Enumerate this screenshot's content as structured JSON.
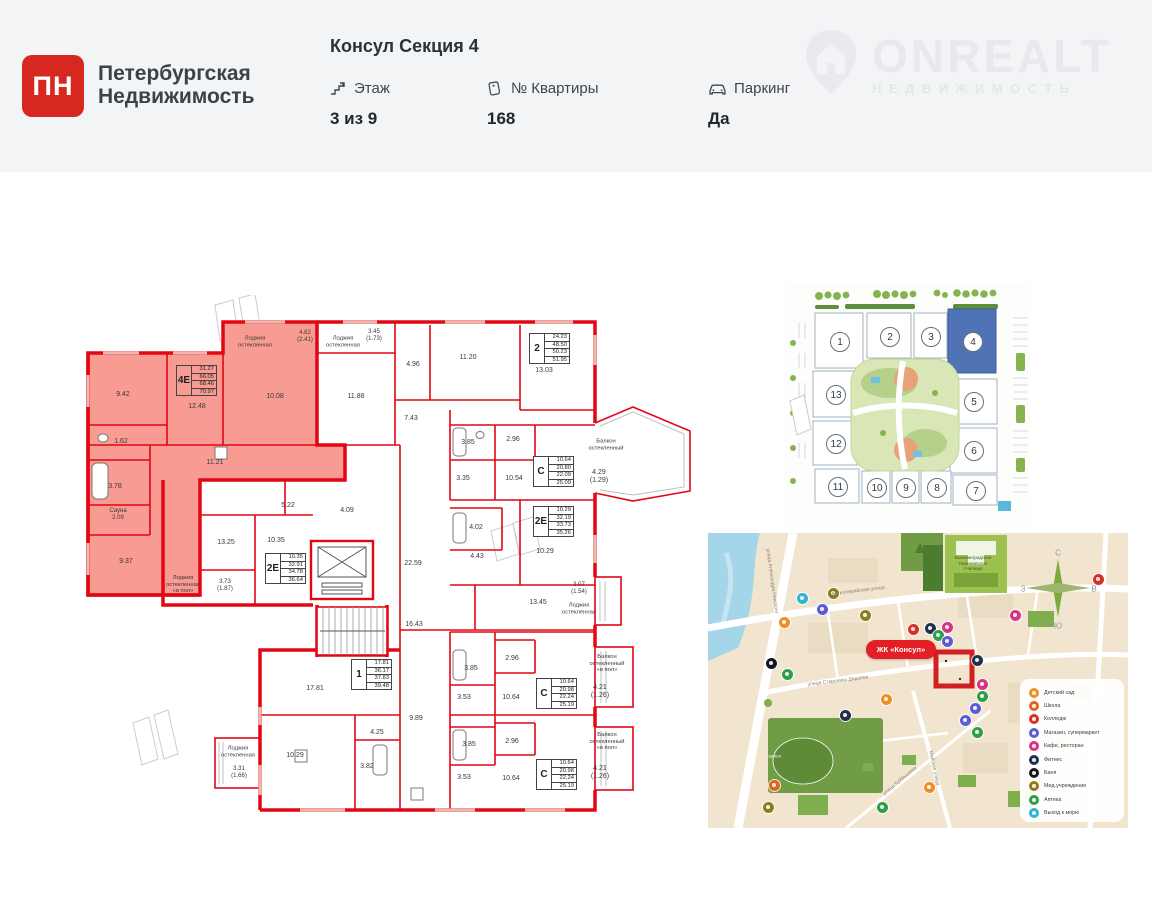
{
  "header": {
    "brand": {
      "logo_text": "ПН",
      "name_line1": "Петербургская",
      "name_line2": "Недвижимость"
    },
    "title": "Консул Секция 4",
    "stats": [
      {
        "icon": "stairs-icon",
        "label": "Этаж",
        "value": "3 из 9"
      },
      {
        "icon": "tag-icon",
        "label": "№ Квартиры",
        "value": "168"
      },
      {
        "icon": "car-icon",
        "label": "Паркинг",
        "value": "Да"
      }
    ],
    "watermark": {
      "text": "ONREALT",
      "subtext": "НЕДВИЖИМОСТЬ"
    }
  },
  "floorplan": {
    "wall_color": "#e30613",
    "highlight_color": "#f89b92",
    "labels": [
      {
        "t": "9.42",
        "x": 68,
        "y": 100
      },
      {
        "t": "12.48",
        "x": 142,
        "y": 112
      },
      {
        "t": "10.08",
        "x": 220,
        "y": 102
      },
      {
        "t": "11.21",
        "x": 160,
        "y": 168
      },
      {
        "t": "1.62",
        "x": 66,
        "y": 147
      },
      {
        "t": "3.78",
        "x": 60,
        "y": 192
      },
      {
        "t": "Сауна\n2.09",
        "x": 63,
        "y": 220,
        "s": 6
      },
      {
        "t": "9.37",
        "x": 71,
        "y": 267
      },
      {
        "t": "Лоджия\nостекленная",
        "x": 200,
        "y": 47,
        "s": 5.8
      },
      {
        "t": "4.82\n(2.41)",
        "x": 250,
        "y": 42,
        "s": 6
      },
      {
        "t": "Лоджия\nостекленная",
        "x": 288,
        "y": 47,
        "s": 5.8
      },
      {
        "t": "3.45\n(1.73)",
        "x": 319,
        "y": 41,
        "s": 6
      },
      {
        "t": "11.88",
        "x": 301,
        "y": 102
      },
      {
        "t": "4.96",
        "x": 358,
        "y": 70
      },
      {
        "t": "11.20",
        "x": 413,
        "y": 63
      },
      {
        "t": "13.03",
        "x": 489,
        "y": 76
      },
      {
        "t": "7.43",
        "x": 356,
        "y": 124
      },
      {
        "t": "3.85",
        "x": 413,
        "y": 148
      },
      {
        "t": "2.96",
        "x": 458,
        "y": 145
      },
      {
        "t": "3.35",
        "x": 408,
        "y": 184
      },
      {
        "t": "10.54",
        "x": 459,
        "y": 184
      },
      {
        "t": "Балкон\nостекленный",
        "x": 551,
        "y": 150,
        "s": 5.8
      },
      {
        "t": "4.29\n(1.29)",
        "x": 544,
        "y": 182
      },
      {
        "t": "5.22",
        "x": 233,
        "y": 211
      },
      {
        "t": "4.09",
        "x": 292,
        "y": 216
      },
      {
        "t": "4.02",
        "x": 421,
        "y": 233
      },
      {
        "t": "4.43",
        "x": 422,
        "y": 262
      },
      {
        "t": "22.59",
        "x": 358,
        "y": 269
      },
      {
        "t": "10.29",
        "x": 490,
        "y": 257
      },
      {
        "t": "13.45",
        "x": 483,
        "y": 308
      },
      {
        "t": "3.07\n(1.54)",
        "x": 524,
        "y": 294,
        "s": 6
      },
      {
        "t": "Лоджия\nостекленная",
        "x": 524,
        "y": 314,
        "s": 5.8
      },
      {
        "t": "13.25",
        "x": 171,
        "y": 248
      },
      {
        "t": "10.35",
        "x": 221,
        "y": 246
      },
      {
        "t": "Лоджия\nостекленная\n«в пол»",
        "x": 128,
        "y": 290,
        "s": 5.8
      },
      {
        "t": "3.73\n(1.87)",
        "x": 170,
        "y": 291,
        "s": 6
      },
      {
        "t": "16.43",
        "x": 359,
        "y": 330
      },
      {
        "t": "9.89",
        "x": 361,
        "y": 424
      },
      {
        "t": "17.81",
        "x": 260,
        "y": 394
      },
      {
        "t": "10.29",
        "x": 240,
        "y": 461
      },
      {
        "t": "4.25",
        "x": 322,
        "y": 438
      },
      {
        "t": "3.82",
        "x": 312,
        "y": 472
      },
      {
        "t": "Лоджия\nостекленная",
        "x": 183,
        "y": 457,
        "s": 5.8
      },
      {
        "t": "3.31\n(1.66)",
        "x": 184,
        "y": 478,
        "s": 6
      },
      {
        "t": "3.85",
        "x": 416,
        "y": 374
      },
      {
        "t": "2.96",
        "x": 457,
        "y": 364
      },
      {
        "t": "3.53",
        "x": 409,
        "y": 403
      },
      {
        "t": "10.64",
        "x": 456,
        "y": 403
      },
      {
        "t": "Балкон\nостекленный\n«в пол»",
        "x": 552,
        "y": 369,
        "s": 5.8
      },
      {
        "t": "4.21\n(1.26)",
        "x": 545,
        "y": 397
      },
      {
        "t": "3.85",
        "x": 414,
        "y": 450
      },
      {
        "t": "2.96",
        "x": 457,
        "y": 447
      },
      {
        "t": "3.53",
        "x": 409,
        "y": 483
      },
      {
        "t": "10.64",
        "x": 456,
        "y": 484
      },
      {
        "t": "Балкон\nостекленный\n«в пол»",
        "x": 552,
        "y": 447,
        "s": 5.8
      },
      {
        "t": "4.21\n(1.26)",
        "x": 545,
        "y": 478
      }
    ],
    "apartments": [
      {
        "type": "4Е",
        "values": [
          "31.27",
          "66.05",
          "68.46",
          "70.97"
        ],
        "x": 121,
        "y": 70,
        "highlight": true
      },
      {
        "type": "2",
        "values": [
          "24.23",
          "48.50",
          "50.23",
          "51.95"
        ],
        "x": 474,
        "y": 38
      },
      {
        "type": "С",
        "values": [
          "10.64",
          "20.80",
          "22.09",
          "25.09"
        ],
        "x": 478,
        "y": 161
      },
      {
        "type": "2Е",
        "values": [
          "10.29",
          "32.19",
          "33.73",
          "35.26"
        ],
        "x": 478,
        "y": 211
      },
      {
        "type": "2Е",
        "values": [
          "10.35",
          "32.91",
          "34.78",
          "36.64"
        ],
        "x": 210,
        "y": 258
      },
      {
        "type": "1",
        "values": [
          "17.81",
          "36.17",
          "37.83",
          "39.48"
        ],
        "x": 296,
        "y": 364
      },
      {
        "type": "С",
        "values": [
          "10.64",
          "20.98",
          "22.24",
          "25.19"
        ],
        "x": 481,
        "y": 383
      },
      {
        "type": "С",
        "values": [
          "10.64",
          "20.98",
          "22.24",
          "25.19"
        ],
        "x": 481,
        "y": 464
      }
    ]
  },
  "siteplan": {
    "highlighted_section": "4",
    "sections": [
      {
        "n": "1",
        "x": 54,
        "y": 58
      },
      {
        "n": "2",
        "x": 104,
        "y": 53
      },
      {
        "n": "3",
        "x": 145,
        "y": 53
      },
      {
        "n": "4",
        "x": 187,
        "y": 58
      },
      {
        "n": "5",
        "x": 188,
        "y": 118
      },
      {
        "n": "6",
        "x": 188,
        "y": 167
      },
      {
        "n": "7",
        "x": 190,
        "y": 207
      },
      {
        "n": "8",
        "x": 151,
        "y": 204
      },
      {
        "n": "9",
        "x": 120,
        "y": 204
      },
      {
        "n": "10",
        "x": 91,
        "y": 204
      },
      {
        "n": "11",
        "x": 52,
        "y": 203
      },
      {
        "n": "12",
        "x": 50,
        "y": 160
      },
      {
        "n": "13",
        "x": 50,
        "y": 111
      }
    ]
  },
  "map": {
    "project_label": "ЖК «Консул»",
    "legend": [
      {
        "label": "Детский сад",
        "color": "#ef8f1f"
      },
      {
        "label": "Школа",
        "color": "#e2641f"
      },
      {
        "label": "Колледж",
        "color": "#d93025"
      },
      {
        "label": "Магазин, супермаркет",
        "color": "#5c5bd6"
      },
      {
        "label": "Кафе, ресторан",
        "color": "#d63384"
      },
      {
        "label": "Фитнес",
        "color": "#20304c"
      },
      {
        "label": "Баня",
        "color": "#14181f"
      },
      {
        "label": "Мед.учреждение",
        "color": "#8f7d1a"
      },
      {
        "label": "Аптека",
        "color": "#2f9e44"
      },
      {
        "label": "Выход к морю",
        "color": "#2fb3d4"
      }
    ],
    "compass": {
      "n": "С",
      "s": "Ю",
      "w": "З",
      "e": "В"
    },
    "streets": [
      {
        "t": "Артиллерийская улица",
        "x": 150,
        "y": 58,
        "r": -7
      },
      {
        "t": "улица Старшины Дадаева",
        "x": 130,
        "y": 148,
        "r": -7
      },
      {
        "t": "Майская улица",
        "x": 226,
        "y": 235,
        "r": 78
      },
      {
        "t": "улица Куйбышева",
        "x": 192,
        "y": 248,
        "r": -40
      },
      {
        "t": "улица Александра Невского",
        "x": 64,
        "y": 48,
        "r": 82
      }
    ],
    "landmarks": [
      {
        "t": "Калининградское\nНахимовское\nУчилище",
        "x": 265,
        "y": 30,
        "c": "#3c5a20"
      },
      {
        "t": "Стадион",
        "x": 64,
        "y": 223,
        "c": "#e8f0dc"
      }
    ],
    "pois": [
      {
        "c": "#2fb3d4",
        "x": 94,
        "y": 65
      },
      {
        "c": "#5c5bd6",
        "x": 114,
        "y": 76
      },
      {
        "c": "#ef8f1f",
        "x": 76,
        "y": 89
      },
      {
        "c": "#8f7d1a",
        "x": 157,
        "y": 82
      },
      {
        "c": "#d93025",
        "x": 205,
        "y": 96
      },
      {
        "c": "#20304c",
        "x": 222,
        "y": 95
      },
      {
        "c": "#d63384",
        "x": 239,
        "y": 94
      },
      {
        "c": "#2f9e44",
        "x": 230,
        "y": 102
      },
      {
        "c": "#5c5bd6",
        "x": 239,
        "y": 108
      },
      {
        "c": "#20304c",
        "x": 269,
        "y": 127
      },
      {
        "c": "#d63384",
        "x": 274,
        "y": 151
      },
      {
        "c": "#2f9e44",
        "x": 274,
        "y": 163
      },
      {
        "c": "#5c5bd6",
        "x": 267,
        "y": 175
      },
      {
        "c": "#14181f",
        "x": 63,
        "y": 130
      },
      {
        "c": "#2f9e44",
        "x": 79,
        "y": 141
      },
      {
        "c": "#ef8f1f",
        "x": 178,
        "y": 166
      },
      {
        "c": "#20304c",
        "x": 137,
        "y": 182
      },
      {
        "c": "#5c5bd6",
        "x": 257,
        "y": 187
      },
      {
        "c": "#2f9e44",
        "x": 269,
        "y": 199
      },
      {
        "c": "#e2641f",
        "x": 66,
        "y": 252
      },
      {
        "c": "#8f7d1a",
        "x": 60,
        "y": 274
      },
      {
        "c": "#ef8f1f",
        "x": 221,
        "y": 254
      },
      {
        "c": "#2f9e44",
        "x": 174,
        "y": 274
      },
      {
        "c": "#d63384",
        "x": 307,
        "y": 82
      },
      {
        "c": "#d93025",
        "x": 390,
        "y": 46
      },
      {
        "c": "#8f7d1a",
        "x": 125,
        "y": 60
      }
    ]
  }
}
